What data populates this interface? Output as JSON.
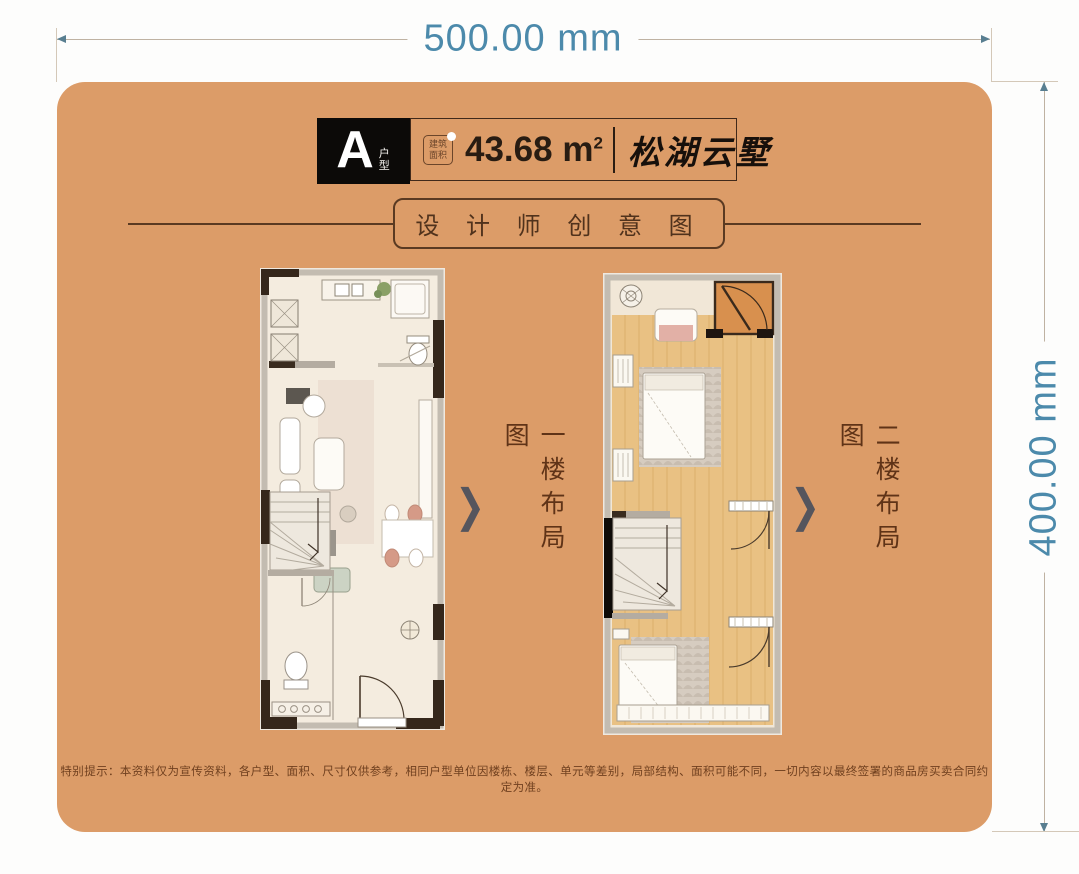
{
  "dimensions": {
    "width_label": "500.00 mm",
    "height_label": "400.00 mm"
  },
  "header": {
    "unit_letter": "A",
    "unit_suffix": "户型",
    "stamp_line1": "建筑",
    "stamp_line2": "面积",
    "area_value": "43.68",
    "area_unit": "m",
    "area_exponent": "2",
    "project_name": "松湖云墅"
  },
  "section_title": "设 计 师 创 意 图",
  "plans": {
    "first": {
      "label": "一楼布局图"
    },
    "second": {
      "label": "二楼布局图"
    }
  },
  "chevron_glyph": "❯",
  "disclaimer": "特别提示：本资料仅为宣传资料，各户型、面积、尺寸仅供参考，相同户型单位因楼栋、楼层、单元等差别，局部结构、面积可能不同，一切内容以最终签署的商品房买卖合同约定为准。",
  "colors": {
    "card_bg": "#dc9c68",
    "dimension_text": "#4c8aab",
    "title_brown": "#5a3a22",
    "wood_floor": "#e9c183",
    "balcony_floor": "#d8904e"
  }
}
